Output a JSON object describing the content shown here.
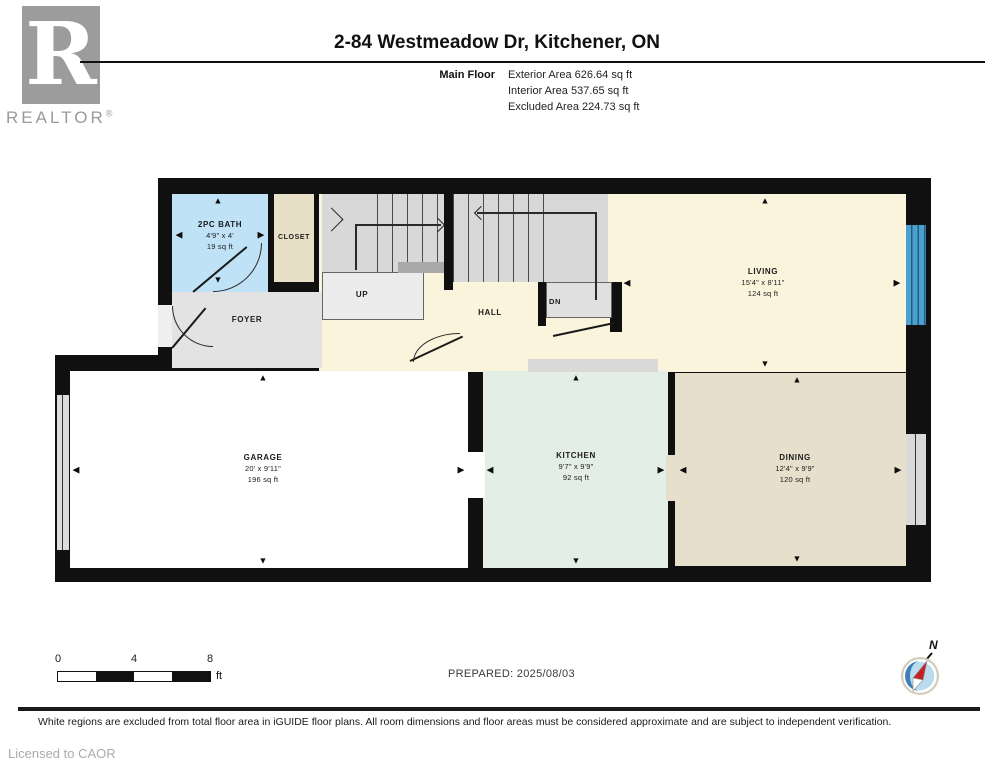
{
  "header": {
    "logo_letter": "R",
    "logo_word": "REALTOR",
    "logo_reg": "®",
    "title": "2-84 Westmeadow Dr, Kitchener, ON",
    "floor_label": "Main Floor",
    "areas": {
      "exterior": "Exterior Area 626.64 sq ft",
      "interior": "Interior Area 537.65 sq ft",
      "excluded": "Excluded Area 224.73 sq ft"
    }
  },
  "rooms": {
    "bath": {
      "name": "2PC BATH",
      "dims": "4'9\" x 4'",
      "area": "19 sq ft"
    },
    "closet": {
      "name": "CLOSET"
    },
    "foyer": {
      "name": "FOYER"
    },
    "hall": {
      "name": "HALL"
    },
    "stairs_up": {
      "label": "UP"
    },
    "stairs_dn": {
      "label": "DN"
    },
    "living": {
      "name": "LIVING",
      "dims": "15'4\" x 8'11\"",
      "area": "124 sq ft"
    },
    "garage": {
      "name": "GARAGE",
      "dims": "20' x 9'11\"",
      "area": "196 sq ft"
    },
    "kitchen": {
      "name": "KITCHEN",
      "dims": "9'7\" x 9'9\"",
      "area": "92 sq ft"
    },
    "dining": {
      "name": "DINING",
      "dims": "12'4\" x 9'9\"",
      "area": "120 sq ft"
    }
  },
  "icons": {
    "up": "▲",
    "down": "▼",
    "left": "◀",
    "right": "▶",
    "compass": "compass-rose",
    "north": "N"
  },
  "footer": {
    "scale_ticks": {
      "t0": "0",
      "t4": "4",
      "t8": "8"
    },
    "scale_unit": "ft",
    "prepared": "PREPARED: 2025/08/03",
    "disclaimer": "White regions are excluded from total floor area in iGUIDE floor plans. All room dimensions and floor areas must be considered approximate and are subject to independent verification.",
    "license": "Licensed to CAOR"
  },
  "colors": {
    "wall": "#101010",
    "bath": "#bfe2f6",
    "closet": "#e8dfc7",
    "stairs": "#d8d8d8",
    "foyer": "#e3e3e3",
    "hall_living": "#fbf4dd",
    "kitchen": "#e3eee7",
    "dining": "#e6dfcb",
    "garage": "#ffffff",
    "window": "#4da0cd",
    "compass_red": "#c42127",
    "compass_blue": "#3f7fb5",
    "compass_light": "#b9dcee"
  }
}
